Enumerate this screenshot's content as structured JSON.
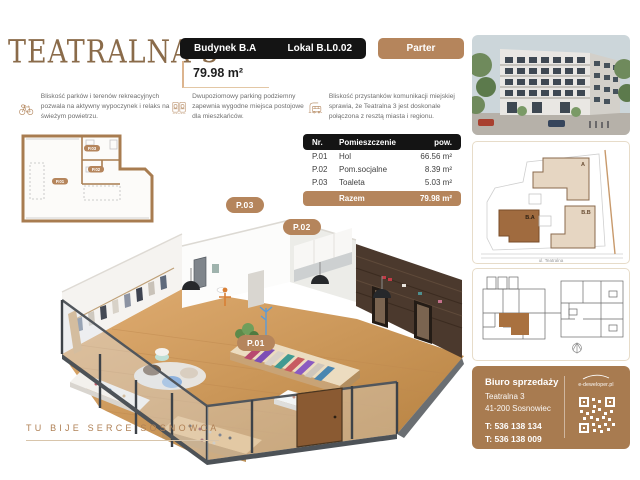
{
  "brand": {
    "logo": "TEATRALNA 3",
    "tagline": "TU BIJE SERCE SOSNOWCA"
  },
  "header": {
    "building": "Budynek B.A",
    "unit": "Lokal B.L0.02",
    "floor": "Parter",
    "area": "79.98 m²"
  },
  "features": [
    {
      "icon": "bicycle-icon",
      "text": "Bliskość parków i terenów rekreacyjnych pozwala na aktywny wypoczynek i relaks na świeżym powietrzu."
    },
    {
      "icon": "parking-icon",
      "text": "Dwupoziomowy parking podziemny zapewnia wygodne miejsca postojowe dla mieszkańców."
    },
    {
      "icon": "bus-icon",
      "text": "Bliskość przystanków komunikacji miejskiej sprawia, że Teatralna 3 jest doskonale połączona z resztą miasta i regionu."
    }
  ],
  "rooms_table": {
    "col_nr": "Nr.",
    "col_name": "Pomieszczenie",
    "col_area": "pow.",
    "rows": [
      {
        "nr": "P.01",
        "name": "Hol",
        "area": "66.56 m²"
      },
      {
        "nr": "P.02",
        "name": "Pom.socjalne",
        "area": "8.39 m²"
      },
      {
        "nr": "P.03",
        "name": "Toaleta",
        "area": "5.03 m²"
      }
    ],
    "total_label": "Razem",
    "total_value": "79.98 m²"
  },
  "plan": {
    "p01": "P.01",
    "p02": "P.02",
    "p03": "P.03"
  },
  "site_plan": {
    "a": "A",
    "bb": "B.B",
    "ba": "B.A",
    "street": "ul. Teatralna"
  },
  "contact": {
    "title": "Biuro sprzedaży",
    "street": "Teatralna 3",
    "city": "41-200 Sosnowiec",
    "phone1": "T: 536 138 134",
    "phone2": "T: 536 138 009",
    "vendor": "e-deweloper.pl"
  },
  "colors": {
    "accent": "#b5855c",
    "accent_dark": "#a87b50",
    "ink": "#141414",
    "logo_brown": "#8a6b4a",
    "wood": "#cf9a62"
  }
}
